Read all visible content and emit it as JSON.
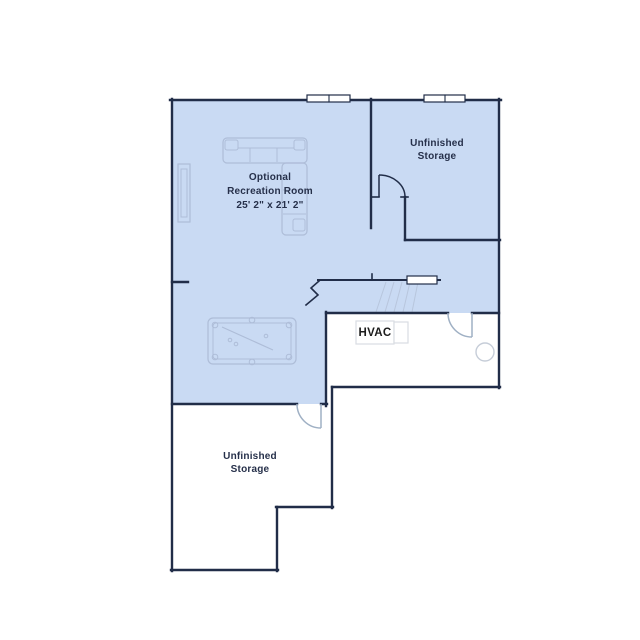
{
  "colors": {
    "background": "#ffffff",
    "room_fill": "#c9daf3",
    "wall": "#212d48",
    "furniture_line": "#aebdd8",
    "door_line": "#9fb0c4",
    "stair_line": "#b8c6dd",
    "equipment_line": "#d9dde2",
    "fixture_line": "#c6cdd8",
    "label_text": "#26304a",
    "hvac_text": "#1c1c1c"
  },
  "labels": {
    "recreation_room": {
      "line1": "Optional",
      "line2": "Recreation Room",
      "dimensions": "25' 2\" x 21' 2\""
    },
    "storage_upper": {
      "line1": "Unfinished",
      "line2": "Storage"
    },
    "storage_lower": {
      "line1": "Unfinished",
      "line2": "Storage"
    },
    "hvac": "HVAC"
  }
}
